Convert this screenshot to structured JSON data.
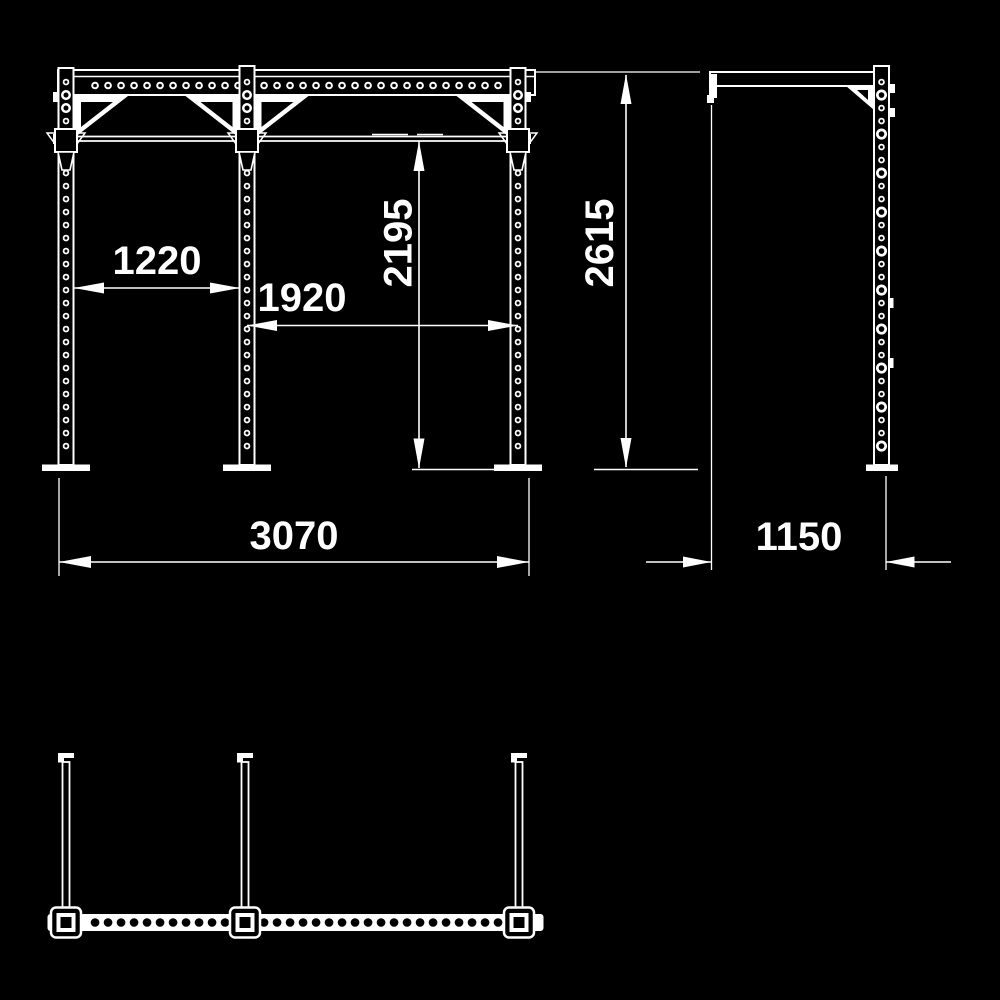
{
  "page": {
    "background_color": "#000000",
    "line_color": "#ffffff"
  },
  "drawing": {
    "type": "technical-orthographic-drawing",
    "subject": "pull-up rig frame",
    "views": [
      "front-elevation",
      "side-elevation",
      "plan-view"
    ]
  },
  "dimensions": {
    "left_bay_width": "1220",
    "right_bay_width": "1920",
    "pullup_bar_height": "2195",
    "overall_height": "2615",
    "overall_width": "3070",
    "overall_depth": "1150"
  }
}
